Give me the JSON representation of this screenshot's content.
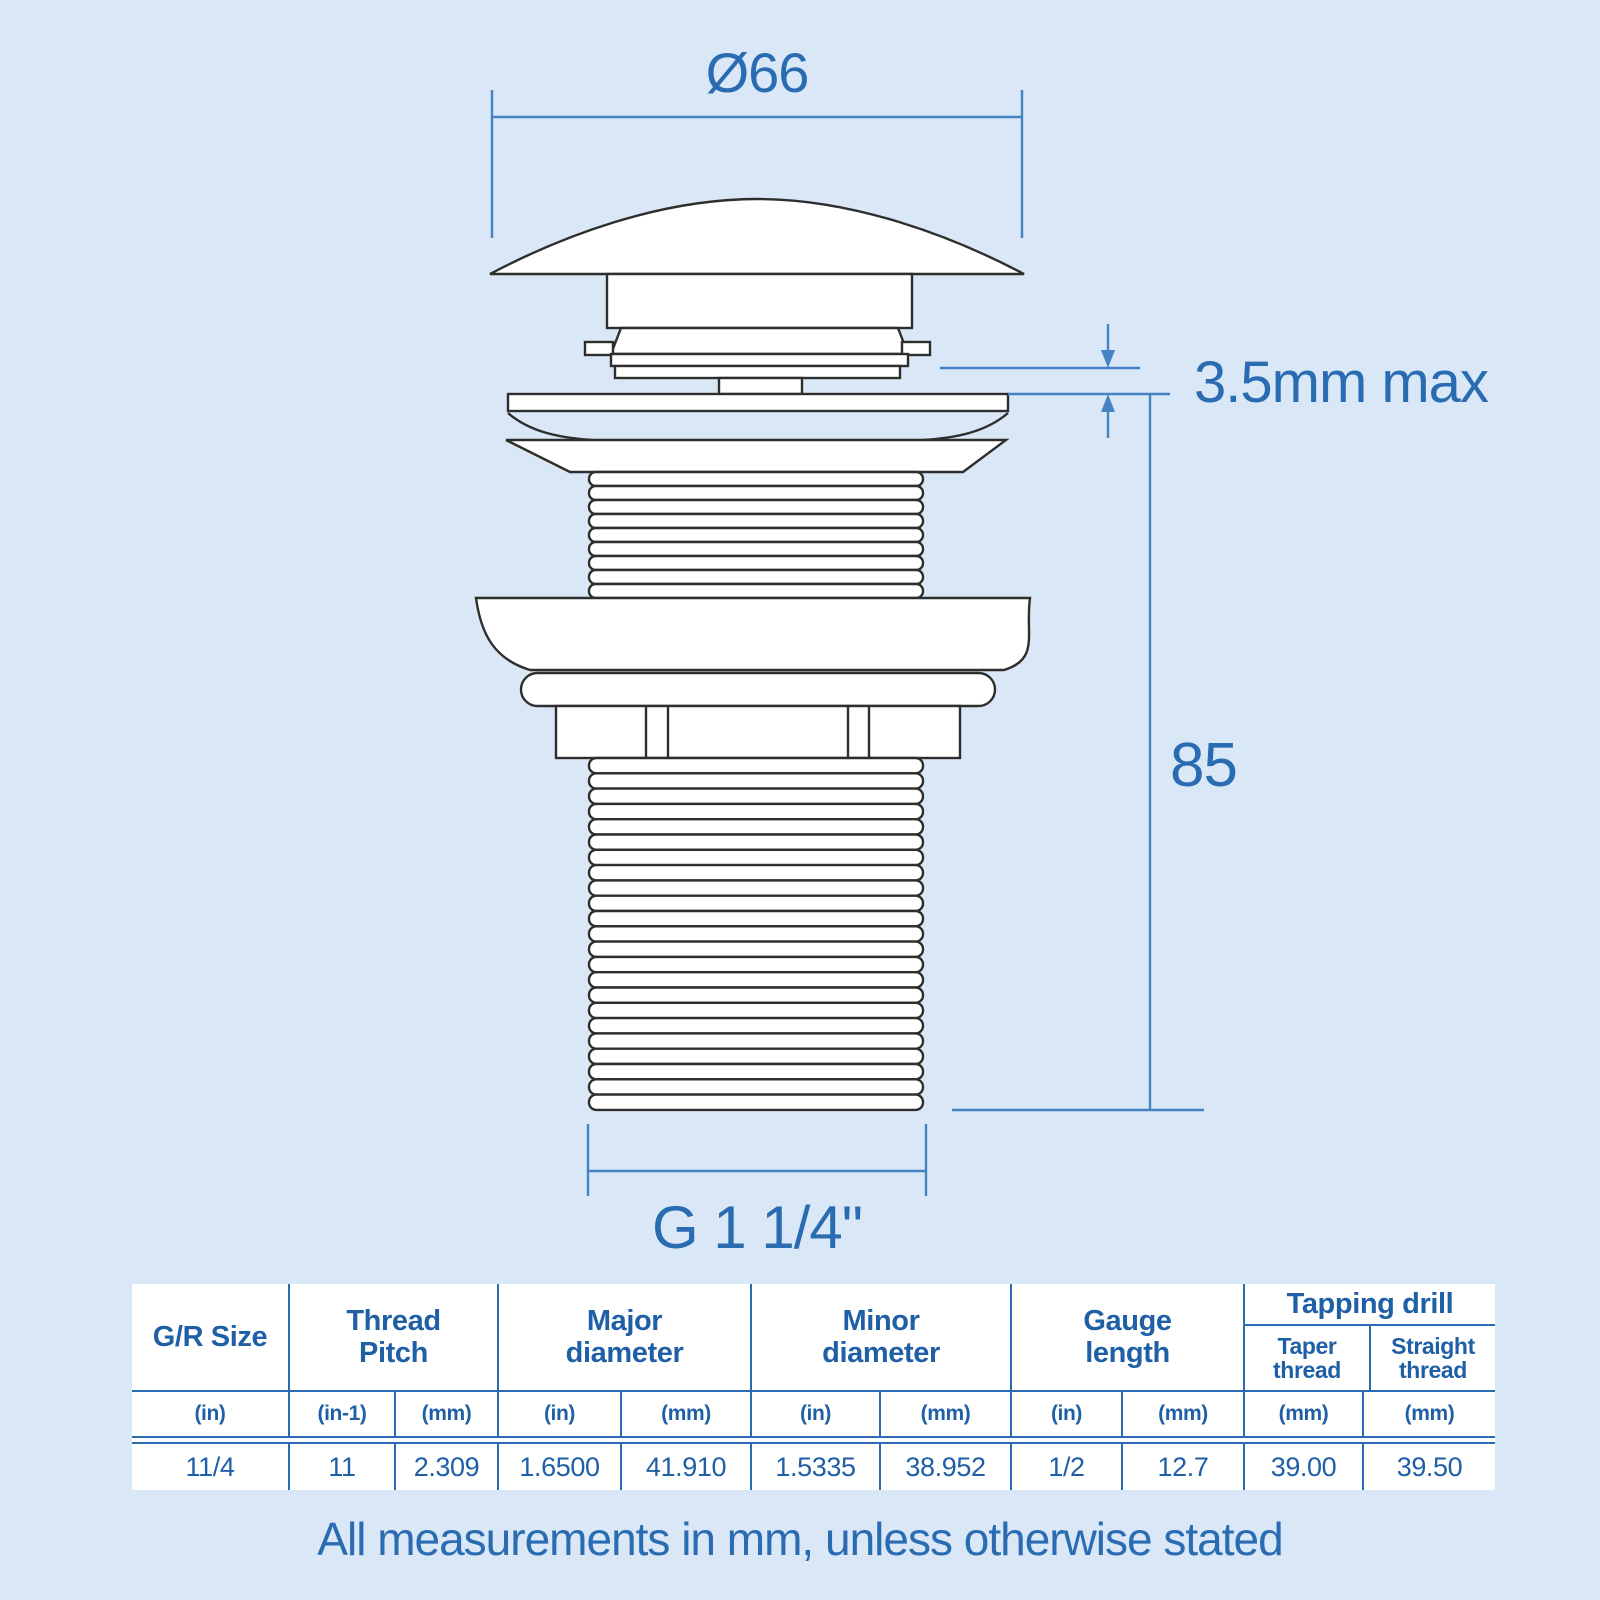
{
  "colors": {
    "background": "#d9e7f6",
    "dimension_line": "#4583c4",
    "dimension_text": "#2a6cb2",
    "table_text": "#1f5fa6",
    "table_grid": "#2a6cb2",
    "drawing_line": "#2e2e2e",
    "part_fill": "#ffffff"
  },
  "diagram": {
    "dimensions": {
      "top_diameter": "Ø66",
      "cap_gap": "3.5mm max",
      "body_length": "85",
      "thread_size": "G 1 1/4\""
    }
  },
  "table": {
    "headers": [
      "G/R Size",
      "Thread Pitch",
      "Major diameter",
      "Minor diameter",
      "Gauge length",
      "Tapping drill"
    ],
    "tapping_subheaders": [
      "Taper thread",
      "Straight thread"
    ],
    "units": [
      "(in)",
      "(in-1)",
      "(mm)",
      "(in)",
      "(mm)",
      "(in)",
      "(mm)",
      "(in)",
      "(mm)",
      "(mm)",
      "(mm)"
    ],
    "values": [
      "11/4",
      "11",
      "2.309",
      "1.6500",
      "41.910",
      "1.5335",
      "38.952",
      "1/2",
      "12.7",
      "39.00",
      "39.50"
    ]
  },
  "footer": {
    "note": "All measurements in mm, unless otherwise stated"
  }
}
